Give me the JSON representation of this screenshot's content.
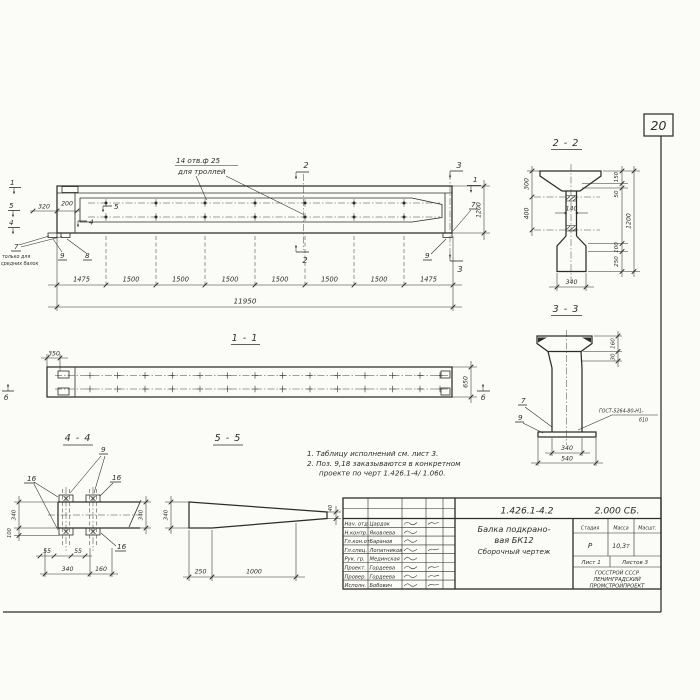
{
  "page": {
    "sheet_number": "20"
  },
  "main_view": {
    "hole_note_line1": "14 отв.ф 25",
    "hole_note_line2": "для троллей",
    "dim_320": "320",
    "dim_200": "200",
    "mark_1_left": "1",
    "mark_5_left": "5",
    "mark_4_left": "4",
    "mark_5_inner": "5",
    "mark_4_inner": "4",
    "mark_2_top": "2",
    "mark_2_bottom": "2",
    "mark_3_top": "3",
    "mark_3_bottom": "3",
    "mark_1_right": "1",
    "pos_7_left": "7",
    "pos_7_note_line1": "только для",
    "pos_7_note_line2": "средних балок",
    "pos_9_left": "9",
    "pos_8": "8",
    "pos_7_right": "7",
    "pos_9_right": "9",
    "dim_1200": "1200",
    "span_dims": [
      "1475",
      "1500",
      "1500",
      "1500",
      "1500",
      "1500",
      "1500",
      "1475"
    ],
    "dim_total": "11950"
  },
  "section_1_1": {
    "title": "1 - 1",
    "dim_350": "350",
    "dim_650": "650",
    "mark_b_left": "б",
    "mark_b_right": "б"
  },
  "section_2_2": {
    "title": "2 - 2",
    "dim_300": "300",
    "dim_400": "400",
    "dim_140": "140",
    "dim_150": "150",
    "dim_50": "50",
    "dim_1200": "1200",
    "dim_100": "100",
    "dim_250": "250",
    "dim_340": "340"
  },
  "section_3_3": {
    "title": "3 - 3",
    "dim_160": "160",
    "dim_30": "30",
    "pos_7": "7",
    "pos_9": "9",
    "weld_note_line1": "ГОСТ-5264-80-Н1-",
    "weld_note_line2": "б10",
    "dim_340": "340",
    "dim_540": "540"
  },
  "section_4_4": {
    "title": "4 - 4",
    "pos_9": "9",
    "pos_16_left": "16",
    "pos_16_right": "16",
    "pos_16_bottom": "16",
    "dim_340_left": "340",
    "dim_100": "100",
    "dim_340_right": "340",
    "dim_55_a": "55",
    "dim_55_b": "55",
    "dim_340_bottom": "340",
    "dim_160": "160"
  },
  "section_5_5": {
    "title": "5 - 5",
    "dim_340": "340",
    "dim_40": "40",
    "dim_250": "250",
    "dim_1000": "1000"
  },
  "notes": {
    "line1": "1. Таблицу исполнений см. лист 3.",
    "line2": "2. Поз. 9,18 заказываются в конкретном",
    "line3": "проекте по черт 1.426.1-4/ 1.060."
  },
  "title_block": {
    "doc_number": "1.426.1-4.2",
    "doc_code": "2.000 СБ.",
    "product_line1": "Балка подкрано-",
    "product_line2": "вая БК12",
    "product_line3": "Сборочный чертеж",
    "col_stage": "Стадия",
    "col_mass": "Масса",
    "col_scale": "Масшт.",
    "stage_value": "Р",
    "mass_value": "10,3т",
    "sheet_label": "Лист 1",
    "sheets_label": "Листов 3",
    "org_line1": "ГОССТРОЙ СССР",
    "org_line2": "ЛЕНИНГРАДСКИЙ",
    "org_line3": "ПРОМСТРОЙПРОЕКТ",
    "roles": [
      {
        "role": "Нач. отд",
        "name": "Цардак"
      },
      {
        "role": "Н.контр.",
        "name": "Яковлева"
      },
      {
        "role": "Гл.кон.от",
        "name": "Баранов"
      },
      {
        "role": "Гл.спец.",
        "name": "Лопатников"
      },
      {
        "role": "Рук. гр.",
        "name": "Мединская"
      },
      {
        "role": "Проект.",
        "name": "Гордеева"
      },
      {
        "role": "Провер.",
        "name": "Гордеева"
      },
      {
        "role": "Исполн.",
        "name": "Бобович"
      }
    ]
  },
  "colors": {
    "ink": "#2e2c29",
    "paper": "#fbfbf8"
  }
}
